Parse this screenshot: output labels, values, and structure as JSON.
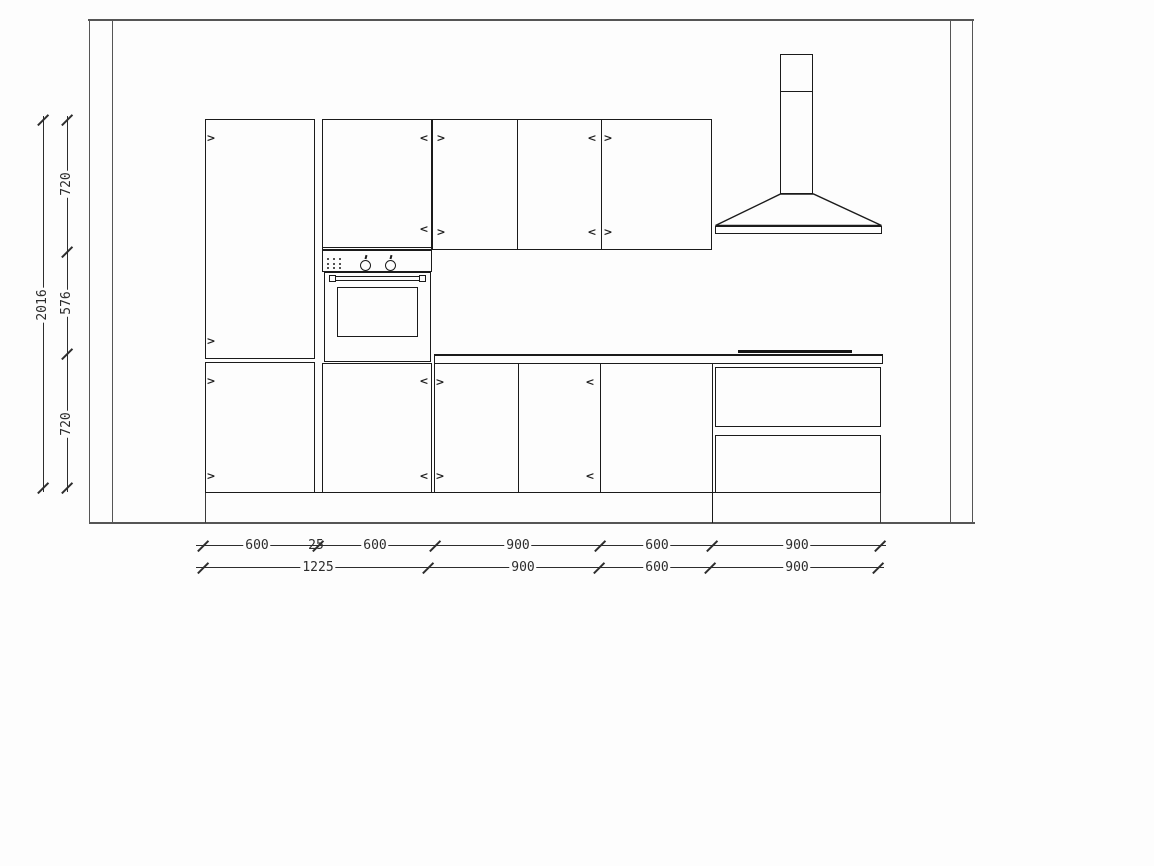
{
  "drawing": {
    "type": "kitchen-elevation",
    "glyphs": {
      "hinge_left": "<",
      "hinge_right": ">"
    },
    "dimensions": {
      "vertical_total": "2016",
      "vertical_segments": [
        "720",
        "576",
        "720"
      ],
      "row1": [
        "600",
        "25",
        "600",
        "900",
        "600",
        "900"
      ],
      "row2": [
        "1225",
        "900",
        "600",
        "900"
      ]
    },
    "colors": {
      "background": "#fdfdfd",
      "cabinet_line": "#1b1b1b",
      "wall_line": "#555555",
      "dimension_line": "#2d2d2d"
    }
  }
}
